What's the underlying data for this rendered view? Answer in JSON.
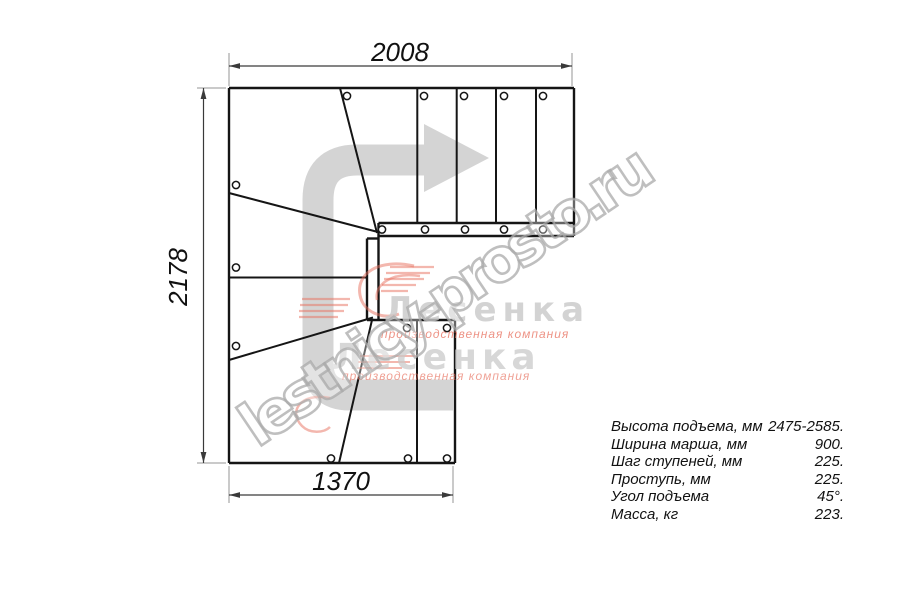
{
  "colors": {
    "line": "#151515",
    "dimension": "#3a3a3a",
    "extension": "#969696",
    "arrow": "#d4d4d4",
    "brand_red": "#e8705e",
    "brand_gray": "#c9c9c9",
    "text": "#111111"
  },
  "dimensions": {
    "top": "2008",
    "left": "2178",
    "bottom": "1370"
  },
  "specs": {
    "rows": [
      {
        "label": "Высота подъема, мм",
        "value": "2475-2585."
      },
      {
        "label": "Ширина марша, мм",
        "value": "900."
      },
      {
        "label": "Шаг ступеней, мм",
        "value": "225."
      },
      {
        "label": "Проступь, мм",
        "value": "225."
      },
      {
        "label": "Угол подъема",
        "value": "45°."
      },
      {
        "label": "Масса, кг",
        "value": "223."
      }
    ]
  },
  "watermarks": {
    "site": "lestnicy-prosto.ru",
    "logo1": {
      "name": "Лесенка",
      "tagline": "производственная компания"
    },
    "logo2": {
      "name": "Лесенка",
      "tagline": "производственная компания"
    }
  }
}
